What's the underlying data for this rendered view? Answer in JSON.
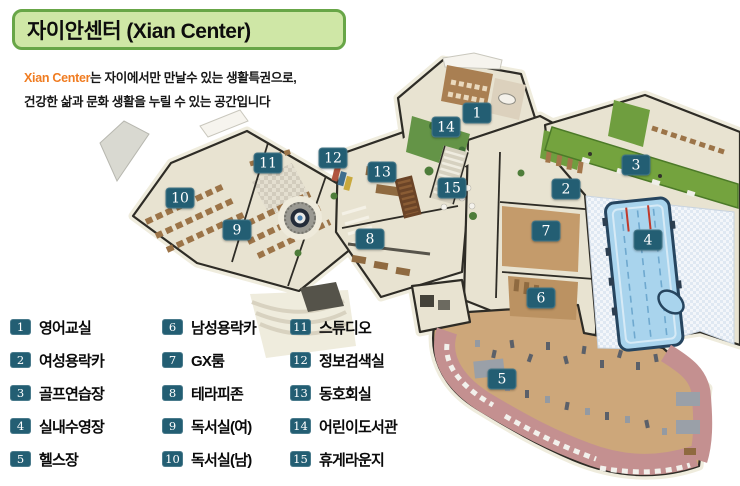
{
  "header": {
    "title": "자이안센터 (Xian Center)",
    "tagline": {
      "brand": "Xian Center",
      "line1_rest": "는 자이에서만 만날수 있는 생활특권으로,",
      "line2": "건강한 삶과 문화 생활을 누릴 수 있는 공간입니다"
    }
  },
  "legend": {
    "columns": [
      {
        "items": [
          {
            "num": "1",
            "label": "영어교실"
          },
          {
            "num": "2",
            "label": "여성용락카"
          },
          {
            "num": "3",
            "label": "골프연습장"
          },
          {
            "num": "4",
            "label": "실내수영장"
          },
          {
            "num": "5",
            "label": "헬스장"
          }
        ]
      },
      {
        "items": [
          {
            "num": "6",
            "label": "남성용락카"
          },
          {
            "num": "7",
            "label": "GX룸"
          },
          {
            "num": "8",
            "label": "테라피존"
          },
          {
            "num": "9",
            "label": "독서실(여)"
          },
          {
            "num": "10",
            "label": "독서실(남)"
          }
        ]
      },
      {
        "items": [
          {
            "num": "11",
            "label": "스튜디오"
          },
          {
            "num": "12",
            "label": "정보검색실"
          },
          {
            "num": "13",
            "label": "동호회실"
          },
          {
            "num": "14",
            "label": "어린이도서관"
          },
          {
            "num": "15",
            "label": "휴게라운지"
          }
        ]
      }
    ]
  },
  "map": {
    "markers": [
      {
        "num": "1",
        "x": 477,
        "y": 113
      },
      {
        "num": "2",
        "x": 566,
        "y": 189
      },
      {
        "num": "3",
        "x": 636,
        "y": 165
      },
      {
        "num": "4",
        "x": 648,
        "y": 240
      },
      {
        "num": "5",
        "x": 502,
        "y": 379
      },
      {
        "num": "6",
        "x": 541,
        "y": 298
      },
      {
        "num": "7",
        "x": 546,
        "y": 231
      },
      {
        "num": "8",
        "x": 370,
        "y": 239
      },
      {
        "num": "9",
        "x": 237,
        "y": 230
      },
      {
        "num": "10",
        "x": 180,
        "y": 198
      },
      {
        "num": "11",
        "x": 268,
        "y": 163
      },
      {
        "num": "12",
        "x": 333,
        "y": 158
      },
      {
        "num": "13",
        "x": 382,
        "y": 172
      },
      {
        "num": "14",
        "x": 446,
        "y": 127
      },
      {
        "num": "15",
        "x": 452,
        "y": 188
      }
    ]
  },
  "colors": {
    "banner_fill": "#cfe7a6",
    "banner_border": "#68a647",
    "brand_orange": "#f07c21",
    "badge_teal": "#235e73",
    "pool_blue": "#a9d4ed",
    "golf_green": "#74a33e",
    "track_pink": "#c49090",
    "wood": "#cda77a",
    "floor_beige": "#e8e3d1",
    "wall_dark": "#2e2c26"
  }
}
